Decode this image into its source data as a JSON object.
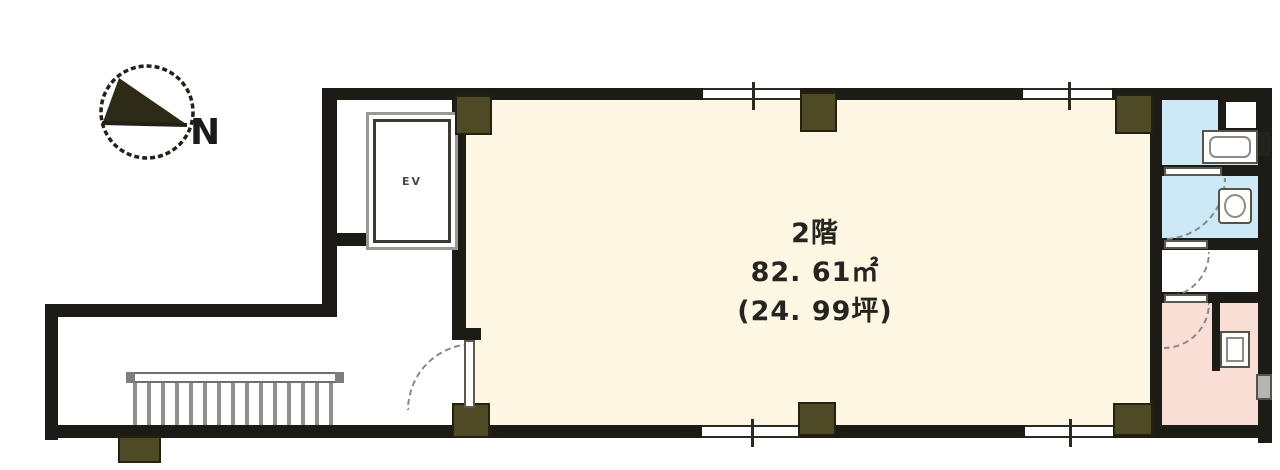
{
  "floor_plan": {
    "title_block": {
      "floor_line": "2階",
      "area_sqm": "82. 61㎡",
      "area_tsubo": "(24. 99坪)"
    },
    "compass": {
      "label": "N"
    },
    "elevator": {
      "label": "EV"
    },
    "colors": {
      "wall": "#1d1b15",
      "pillar": "#4e4a26",
      "main_room_floor": "#fcf6e3",
      "wet_room_blue": "#cde9f6",
      "bath_room_pink": "#f9ded6",
      "corridor_white": "#ffffff",
      "stair_gray": "#8f8f8f"
    }
  }
}
